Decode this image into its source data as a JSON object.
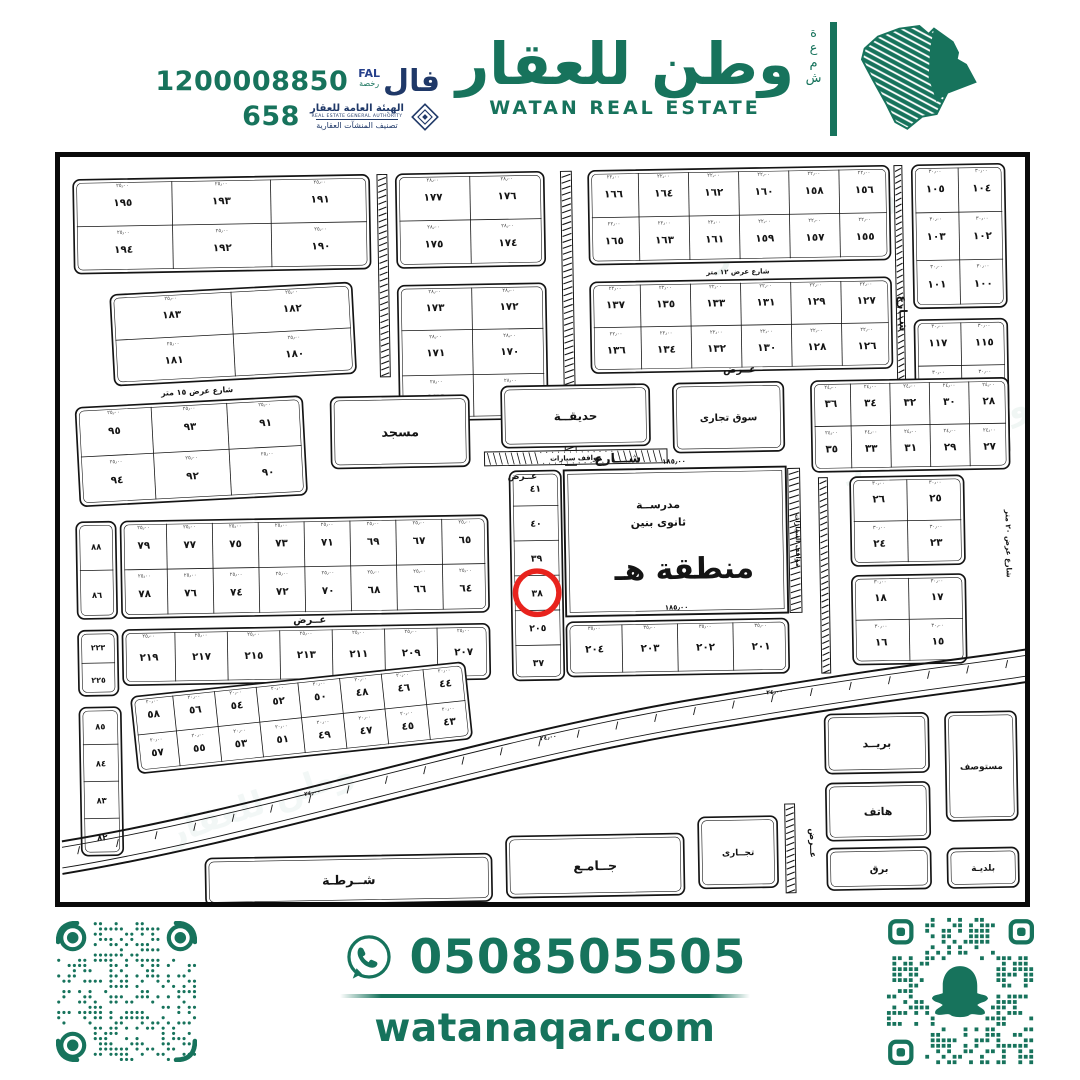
{
  "colors": {
    "brand_green": "#17735C",
    "authority_navy": "#1F3868",
    "map_ink": "#141414",
    "highlight_red": "#E8231D",
    "background": "#FFFFFF"
  },
  "header": {
    "license": {
      "phone": "1200008850",
      "number": "658",
      "fal_ar": "فال",
      "fal_en": "FAL",
      "fal_sub": "رخصة",
      "authority_ar": "الهيئة العامة للعقار",
      "authority_en": "REAL ESTATE GENERAL AUTHORITY",
      "authority_sub": "تصنيف المنشآت العقارية"
    },
    "brand": {
      "name_ar": "وطن للعقار",
      "name_en": "WATAN REAL ESTATE",
      "vertical_word": "شمعة"
    }
  },
  "footer": {
    "whatsapp": "0508505505",
    "website": "watanaqar.com"
  },
  "map": {
    "highlight_plot": "٣٨",
    "school": {
      "x": 510,
      "y": 318,
      "w": 225,
      "h": 148,
      "line1": "مدرســة",
      "line2": "ثانوى بنين",
      "zone": "منطقة  هـ",
      "dim_top": "١٨٥٫٠٠",
      "dim_bottom": "١٨٥٫٠٠"
    },
    "watermark": "وطن للعقار",
    "strips": [
      {
        "x": 326,
        "y": 15,
        "w": 10,
        "h": 205
      },
      {
        "x": 512,
        "y": 15,
        "w": 11,
        "h": 298
      },
      {
        "x": 768,
        "y": 330,
        "w": 9,
        "h": 198
      },
      {
        "x": 728,
        "y": 660,
        "w": 10,
        "h": 90
      },
      {
        "x": 850,
        "y": 15,
        "w": 8,
        "h": 295
      },
      {
        "x": 737,
        "y": 320,
        "w": 12,
        "h": 146
      },
      {
        "x": 430,
        "y": 298,
        "w": 185,
        "h": 14,
        "label": "مواقف سيارات"
      }
    ],
    "street_labels": [
      {
        "t": "شـــارع",
        "x": 565,
        "y": 311,
        "r": 0,
        "s": 13
      },
      {
        "t": "عــرض",
        "x": 468,
        "y": 326,
        "r": 0,
        "s": 9
      },
      {
        "t": "شارع عرض ١٥ متر",
        "x": 140,
        "y": 234,
        "r": -2,
        "s": 8
      },
      {
        "t": "عــرض",
        "x": 250,
        "y": 468,
        "r": 0,
        "s": 10
      },
      {
        "t": "عــرض",
        "x": 690,
        "y": 222,
        "r": 0,
        "s": 10
      },
      {
        "t": "شارع عرض ١٢ متر",
        "x": 690,
        "y": 122,
        "r": 0,
        "s": 7
      },
      {
        "t": "شــارع",
        "x": 853,
        "y": 165,
        "r": 90,
        "s": 11
      },
      {
        "t": "شارع عرض ٢٠ متر",
        "x": 957,
        "y": 400,
        "r": 90,
        "s": 7.5
      },
      {
        "t": "عــرض",
        "x": 753,
        "y": 700,
        "r": 90,
        "s": 9
      },
      {
        "t": "مواقف السيارات",
        "x": 744,
        "y": 393,
        "r": 90,
        "s": 6.5
      },
      {
        "t": "١٨٥٫٠٠",
        "x": 622,
        "y": 313,
        "r": 0,
        "s": 7
      },
      {
        "t": "١٨٥٫٠٠",
        "x": 622,
        "y": 461,
        "r": 0,
        "s": 7
      },
      {
        "t": "٢٤٫٠٠",
        "x": 250,
        "y": 642,
        "r": -10,
        "s": 6
      },
      {
        "t": "٢٤٫٠٠",
        "x": 490,
        "y": 590,
        "r": -8,
        "s": 6
      },
      {
        "t": "٢٤٫٠٠",
        "x": 720,
        "y": 548,
        "r": -4,
        "s": 6
      }
    ],
    "blocks": [
      {
        "x": 18,
        "y": 15,
        "w": 300,
        "h": 95,
        "dim": "٢٥٫٠٠",
        "rows": [
          [
            "١٩٥",
            "١٩٣",
            "١٩١"
          ],
          [
            "١٩٤",
            "١٩٢",
            "١٩٠"
          ]
        ]
      },
      {
        "x": 345,
        "y": 15,
        "w": 150,
        "h": 95,
        "dim": "٢٨٫٠٠",
        "rows": [
          [
            "١٧٧",
            "١٧٦"
          ],
          [
            "١٧٥",
            "١٧٤"
          ]
        ]
      },
      {
        "x": 540,
        "y": 15,
        "w": 305,
        "h": 95,
        "dim": "٢٢٫٠٠",
        "rows": [
          [
            "١٦٦",
            "١٦٤",
            "١٦٢",
            "١٦٠",
            "١٥٨",
            "١٥٦"
          ],
          [
            "١٦٥",
            "١٦٣",
            "١٦١",
            "١٥٩",
            "١٥٧",
            "١٥٥"
          ]
        ]
      },
      {
        "x": 868,
        "y": 15,
        "w": 94,
        "h": 145,
        "dim": "٣٠٫٠٠",
        "rows": [
          [
            "١٠٥",
            "١٠٤"
          ],
          [
            "١٠٣",
            "١٠٢"
          ],
          [
            "١٠١",
            "١٠٠"
          ]
        ]
      },
      {
        "x": 55,
        "y": 128,
        "w": 245,
        "h": 92,
        "rot": -2,
        "dim": "٢٥٫٠٠",
        "rows": [
          [
            "١٨٣",
            "١٨٢"
          ],
          [
            "١٨١",
            "١٨٠"
          ]
        ]
      },
      {
        "x": 345,
        "y": 128,
        "w": 150,
        "h": 137,
        "dim": "٢٨٫٠٠",
        "rows": [
          [
            "١٧٣",
            "١٧٢"
          ],
          [
            "١٧١",
            "١٧٠"
          ],
          [
            "١٦٩",
            "١٦٨"
          ]
        ]
      },
      {
        "x": 540,
        "y": 128,
        "w": 305,
        "h": 92,
        "dim": "٢٢٫٠٠",
        "rows": [
          [
            "١٣٧",
            "١٣٥",
            "١٣٣",
            "١٣١",
            "١٢٩",
            "١٢٧"
          ],
          [
            "١٣٦",
            "١٣٤",
            "١٣٢",
            "١٣٠",
            "١٢٨",
            "١٢٦"
          ]
        ]
      },
      {
        "x": 868,
        "y": 172,
        "w": 94,
        "h": 140,
        "dim": "٣٠٫٠٠",
        "rows": [
          [
            "١١٧",
            "١١٥"
          ],
          [
            "١١٣",
            "١١١"
          ],
          [
            "١٠٩",
            "١٠٧"
          ]
        ]
      },
      {
        "x": 18,
        "y": 242,
        "w": 230,
        "h": 100,
        "rot": -2,
        "dim": "٢٥٫٠٠",
        "rows": [
          [
            "٩٥",
            "٩٣",
            "٩١"
          ],
          [
            "٩٤",
            "٩٢",
            "٩٠"
          ]
        ]
      },
      {
        "x": 275,
        "y": 240,
        "w": 140,
        "h": 72,
        "label": "مسجد",
        "fs": 13
      },
      {
        "x": 448,
        "y": 232,
        "w": 150,
        "h": 62,
        "label": "حديقــة",
        "fs": 12
      },
      {
        "x": 622,
        "y": 232,
        "w": 112,
        "h": 70,
        "label": "سوق تجارى",
        "fs": 10
      },
      {
        "x": 762,
        "y": 232,
        "w": 200,
        "h": 92,
        "dim": "٢٤٫٠٠",
        "rows": [
          [
            "٣٦",
            "٣٤",
            "٣٢",
            "٣٠",
            "٢٨"
          ],
          [
            "٣٥",
            "٣٣",
            "٣١",
            "٢٩",
            "٢٧"
          ]
        ]
      },
      {
        "x": 455,
        "y": 318,
        "w": 52,
        "h": 212,
        "fs": 9.5,
        "rows": [
          [
            "٤١"
          ],
          [
            "٤٠"
          ],
          [
            "٣٩"
          ],
          [
            "٣٨"
          ],
          [
            "٢٠٥"
          ],
          [
            "٣٧"
          ]
        ]
      },
      {
        "x": 60,
        "y": 362,
        "w": 372,
        "h": 98,
        "dim": "٢٥٫٠٠",
        "rows": [
          [
            "٧٩",
            "٧٧",
            "٧٥",
            "٧٣",
            "٧١",
            "٦٩",
            "٦٧",
            "٦٥"
          ],
          [
            "٧٨",
            "٧٦",
            "٧٤",
            "٧٢",
            "٧٠",
            "٦٨",
            "٦٦",
            "٦٤"
          ]
        ]
      },
      {
        "x": 15,
        "y": 362,
        "w": 40,
        "h": 98,
        "fs": 8.5,
        "rows": [
          [
            "٨٨"
          ],
          [
            "٨٦"
          ]
        ]
      },
      {
        "x": 60,
        "y": 472,
        "w": 372,
        "h": 56,
        "dim": "٢٥٫٠٠",
        "rows": [
          [
            "٢١٩",
            "٢١٧",
            "٢١٥",
            "٢١٣",
            "٢١١",
            "٢٠٩",
            "٢٠٧"
          ]
        ]
      },
      {
        "x": 15,
        "y": 472,
        "w": 40,
        "h": 66,
        "fs": 8,
        "rows": [
          [
            "٢٢٣"
          ],
          [
            "٢٢٥"
          ]
        ]
      },
      {
        "x": 510,
        "y": 472,
        "w": 225,
        "h": 55,
        "dim": "٣٥٫٠٠",
        "rows": [
          [
            "٢٠٤",
            "٢٠٣",
            "٢٠٢",
            "٢٠١"
          ]
        ]
      },
      {
        "x": 70,
        "y": 525,
        "w": 340,
        "h": 78,
        "rot": -5,
        "dim": "٢٠٫٠٠",
        "rows": [
          [
            "٥٨",
            "٥٦",
            "٥٤",
            "٥٢",
            "٥٠",
            "٤٨",
            "٤٦",
            "٤٤"
          ],
          [
            "٥٧",
            "٥٥",
            "٥٣",
            "٥١",
            "٤٩",
            "٤٧",
            "٤٥",
            "٤٣"
          ]
        ]
      },
      {
        "x": 15,
        "y": 550,
        "w": 42,
        "h": 150,
        "fs": 8.5,
        "rows": [
          [
            "٨٥"
          ],
          [
            "٨٤"
          ],
          [
            "٨٣"
          ],
          [
            "٨٢"
          ]
        ]
      },
      {
        "x": 800,
        "y": 330,
        "w": 115,
        "h": 90,
        "dim": "٣٠٫٠٠",
        "rows": [
          [
            "٢٦",
            "٢٥"
          ],
          [
            "٢٤",
            "٢٣"
          ]
        ]
      },
      {
        "x": 800,
        "y": 430,
        "w": 115,
        "h": 90,
        "dim": "٣٠٫٠٠",
        "rows": [
          [
            "١٨",
            "١٧"
          ],
          [
            "١٦",
            "١٥"
          ]
        ]
      },
      {
        "x": 140,
        "y": 705,
        "w": 290,
        "h": 48,
        "label": "شــرطـة",
        "fs": 13
      },
      {
        "x": 445,
        "y": 688,
        "w": 180,
        "h": 62,
        "label": "جــامـع",
        "fs": 13
      },
      {
        "x": 640,
        "y": 672,
        "w": 80,
        "h": 72,
        "label": "تجــارى",
        "fs": 9
      },
      {
        "x": 770,
        "y": 570,
        "w": 105,
        "h": 60,
        "label": "بريــد",
        "fs": 11
      },
      {
        "x": 770,
        "y": 640,
        "w": 105,
        "h": 58,
        "label": "هاتف",
        "fs": 11
      },
      {
        "x": 770,
        "y": 706,
        "w": 105,
        "h": 42,
        "label": "برق",
        "fs": 10
      },
      {
        "x": 892,
        "y": 570,
        "w": 72,
        "h": 110,
        "label": "مستوصف",
        "fs": 9
      },
      {
        "x": 892,
        "y": 708,
        "w": 72,
        "h": 40,
        "label": "بلديـة",
        "fs": 9
      }
    ]
  }
}
